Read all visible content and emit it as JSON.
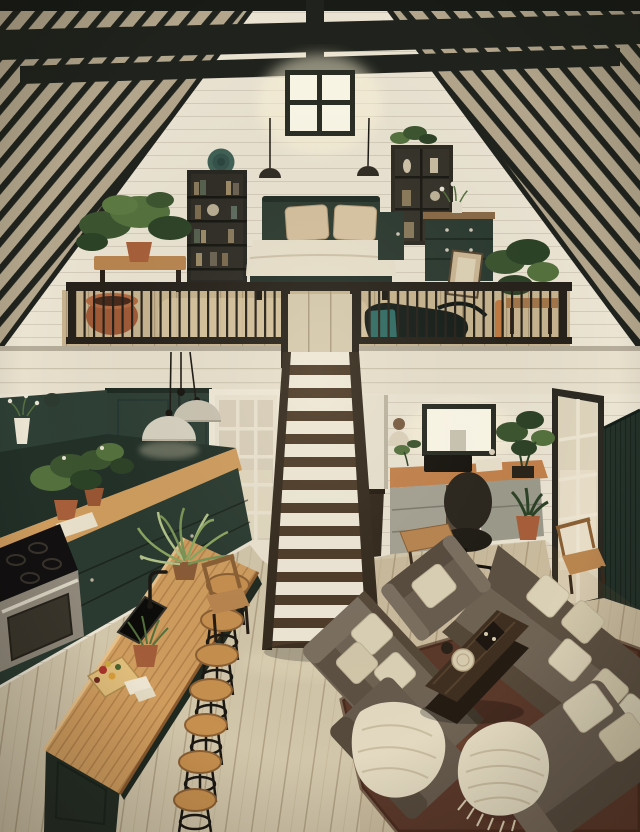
{
  "meta": {
    "kind": "interior-photograph",
    "subject": "two-story tiny house loft interior",
    "width": 640,
    "height": 832
  },
  "palette": {
    "wall": "#ebe4d3",
    "fascia": "#e8e0cd",
    "beam": "#20231d",
    "ridge": "#181b16",
    "rafter": "#b3a68c",
    "glow": "#fdf9e9",
    "winframe": "#292c23",
    "green": "#2c3b31",
    "greendeep": "#223028",
    "wood": "#cf9c5e",
    "floor": "#d2c6aa",
    "loftfloor": "#c8b48f",
    "tread": "#4d3a28",
    "riser": "#efe8d7",
    "stringer": "#342a1e",
    "rail": "#26211a",
    "sofa": "#6f6354",
    "sofaback": "#5d5142",
    "sofadark": "#554839",
    "sofalight": "#7b6f60",
    "pillow": "#dbd1b6",
    "rug": "#5b392a",
    "terracotta": "#a85f3a",
    "plant": "#3c5430",
    "plant2": "#54713d",
    "plant3": "#2c4226",
    "duvet": "#e9e1cc",
    "bedpillow": "#d5c09e",
    "pendant": "#d7d1c1",
    "deskwood": "#c3814b",
    "drawer": "#a5a294",
    "steel": "#8f887a",
    "ink": "#17140f",
    "cream": "#e9e1cd",
    "woodchair": "#b9854f",
    "teal": "#2f6b64",
    "stoolwood": "#c68f4e"
  },
  "scene": {
    "loft": [
      "gabled-roof-with-dark-rafters",
      "collar-beams",
      "glowing-gable-window",
      "two-dark-pendant-lights",
      "decorative-green-plate",
      "black-bookshelf",
      "green-bed-with-cream-duvet",
      "two-beige-pillows",
      "green-locker",
      "green-dresser-with-flowers",
      "leaning-picture-frame",
      "potted-plants",
      "terracotta-floor-pot",
      "teal-bag",
      "black-metal-railing"
    ],
    "kitchen": [
      "dark-green-upper-cabinets",
      "white-flower-vase",
      "dark-green-pantry",
      "wood-wall-counter",
      "counter-plants",
      "dark-green-base-cabinets",
      "stainless-range-black-cooktop",
      "two-cream-dome-pendants",
      "wood-island-with-sink",
      "black-faucet",
      "spider-plant",
      "cutting-board-with-food",
      "seven-wood-bar-stools"
    ],
    "center": [
      "white-french-door-15-pane",
      "staircase-dark-treads-white-risers",
      "stair-landing"
    ],
    "office": [
      "glowing-office-window",
      "bust-sculpture",
      "wood-desk",
      "monitor",
      "grey-drawer-pedestals",
      "black-office-chair",
      "monstera-plant",
      "terracotta-potted-plant",
      "white-tall-cabinet",
      "dark-bin"
    ],
    "living": [
      "white-french-door-right",
      "dark-green-beadboard-wainscot",
      "taupe-sectional-sofa",
      "top-armchair",
      "bottom-right-armchair",
      "cream-throw-pillows",
      "ribbed-cream-throw-blankets",
      "dark-wood-coffee-table",
      "cream-plate",
      "dark-tray",
      "red-brown-rug",
      "plank-wood-floor",
      "wood-bench",
      "wood-side-chairs"
    ]
  }
}
